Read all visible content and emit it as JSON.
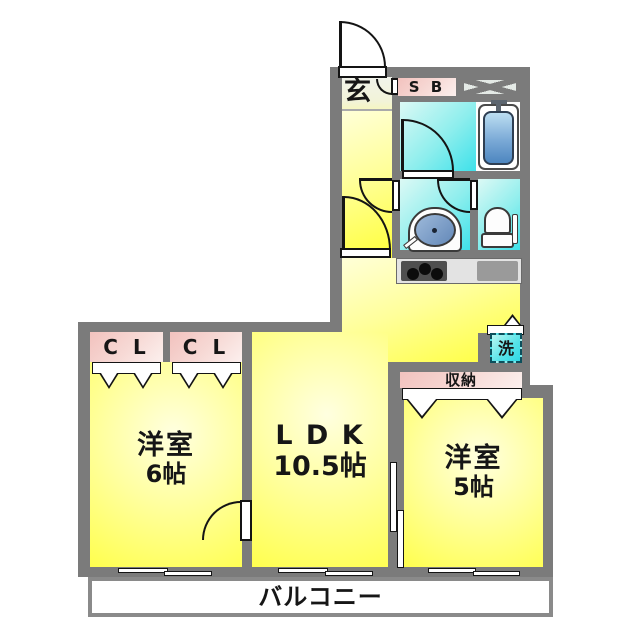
{
  "plan": {
    "type": "japanese-apartment-floor-plan",
    "colors": {
      "wall_gray": "#7b7b7b",
      "room_yellow": "#ffff37",
      "room_yellow_light": "#ffffd8",
      "wet_area_cyan": "#3ee1ea",
      "wet_area_cyan_light": "#dcf9f5",
      "closet_pink": "#f2c2be",
      "bathtub_blue": "#4d86c0",
      "laundry_turquoise": "#2fd9e6",
      "balcony_white": "#ffffff",
      "line_black": "#141414"
    },
    "labels": {
      "genkan": "玄",
      "shoe_box": "S B",
      "laundry": "洗",
      "closet_1": "C L",
      "closet_2": "C L",
      "storage": "収納",
      "room6_name": "洋室",
      "room6_size": "6帖",
      "ldk_name": "L D K",
      "ldk_size": "10.5帖",
      "room5_name": "洋室",
      "room5_size": "5帖",
      "balcony": "バルコニー"
    }
  }
}
